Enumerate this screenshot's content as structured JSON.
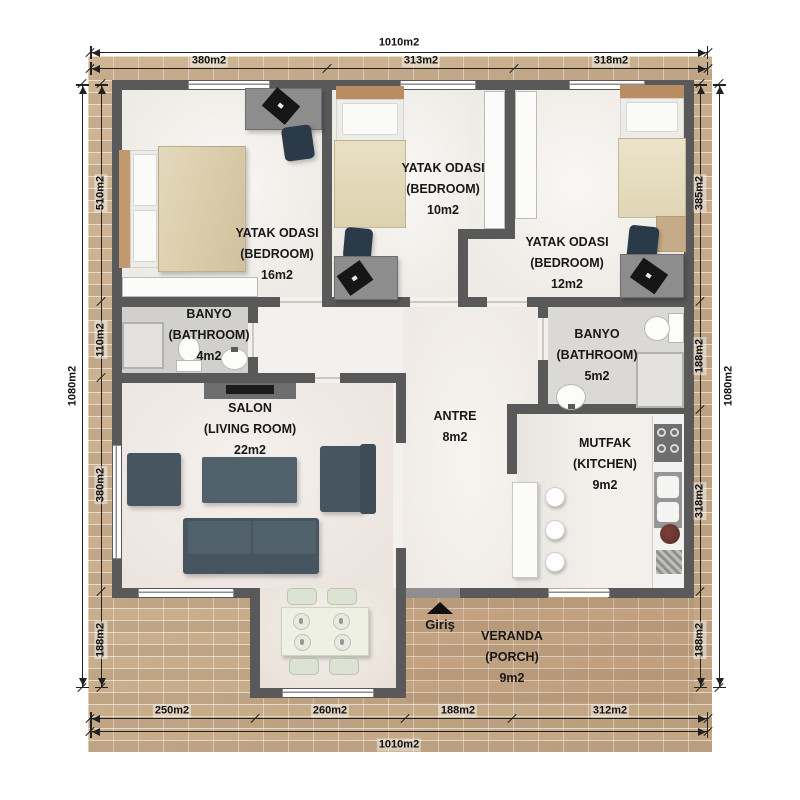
{
  "rooms": {
    "bedroom_left": {
      "name": "YATAK ODASI",
      "type": "(BEDROOM)",
      "area": "16m2"
    },
    "bedroom_middle": {
      "name": "YATAK ODASI",
      "type": "(BEDROOM)",
      "area": "10m2"
    },
    "bedroom_right": {
      "name": "YATAK ODASI",
      "type": "(BEDROOM)",
      "area": "12m2"
    },
    "bathroom_left": {
      "name": "BANYO",
      "type": "(BATHROOM)",
      "area": "4m2"
    },
    "bathroom_right": {
      "name": "BANYO",
      "type": "(BATHROOM)",
      "area": "5m2"
    },
    "living_room": {
      "name": "SALON",
      "type": "(LIVING ROOM)",
      "area": "22m2"
    },
    "hallway": {
      "name": "ANTRE",
      "area": "8m2"
    },
    "kitchen": {
      "name": "MUTFAK",
      "type": "(KITCHEN)",
      "area": "9m2"
    },
    "porch": {
      "name": "VERANDA",
      "type": "(PORCH)",
      "area": "9m2"
    }
  },
  "entrance": {
    "label": "Giriş"
  },
  "dimensions": {
    "top": {
      "total": "1010m2",
      "segments": [
        "380m2",
        "313m2",
        "318m2"
      ]
    },
    "bottom": {
      "total": "1010m2",
      "segments": [
        "250m2",
        "260m2",
        "188m2",
        "312m2"
      ]
    },
    "left": {
      "total": "1080m2",
      "segments": [
        "510m2",
        "110m2",
        "380m2",
        "188m2"
      ]
    },
    "right": {
      "total": "1080m2",
      "segments": [
        "385m2",
        "188m2",
        "318m2",
        "188m2"
      ]
    }
  },
  "colors": {
    "wall": "#595959",
    "brick": "#c9ae8c",
    "floor": "#f3f0ed",
    "sofa": "#46555f",
    "bed_blanket": "#dccfae",
    "chair": "#2b3a49"
  }
}
